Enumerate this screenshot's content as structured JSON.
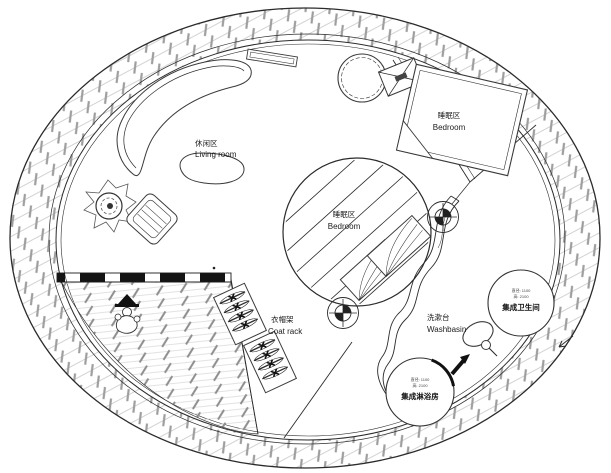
{
  "plan": {
    "areas": {
      "living_room": {
        "label_zh": "休闲区",
        "label_en": "Living room"
      },
      "bedroom_upper": {
        "label_zh": "睡眠区",
        "label_en": "Bedroom"
      },
      "bedroom_center": {
        "label_zh": "睡眠区",
        "label_en": "Bedroom"
      },
      "coat_rack": {
        "label_zh": "衣帽架",
        "label_en": "Coat rack"
      },
      "washbasin": {
        "label_zh": "洗漱台",
        "label_en": "Washbasin"
      },
      "bathroom_pod": {
        "label_zh": "集成卫生间",
        "spec_diameter": "直径: 1100",
        "spec_height": "高: 2100"
      },
      "shower_pod": {
        "label_zh": "集成淋浴房",
        "spec_diameter": "直径: 1100",
        "spec_height": "高: 2100"
      }
    },
    "colors": {
      "line": "#2b2b2b",
      "hatch_light": "#d2d2d2",
      "hatch_dark": "#9e9e9e",
      "background": "#ffffff"
    }
  }
}
